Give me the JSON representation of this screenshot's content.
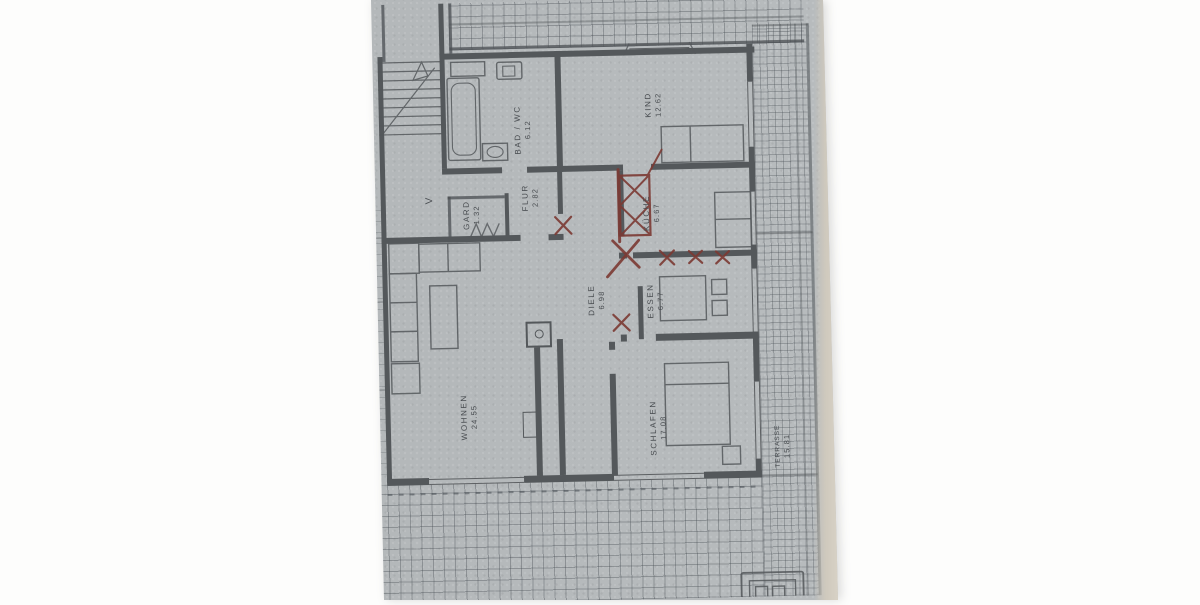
{
  "rooms": {
    "kind": {
      "name": "KIND",
      "area": "12.62"
    },
    "bad": {
      "name": "BAD / WC",
      "area": "6.12"
    },
    "flur": {
      "name": "FLUR",
      "area": "2.82"
    },
    "gard": {
      "name": "GARD",
      "area": "1.32"
    },
    "kueche": {
      "name": "KÜCHE",
      "area": "6.67"
    },
    "diele": {
      "name": "DIELE",
      "area": "6.98"
    },
    "essen": {
      "name": "ESSEN",
      "area": "6.77"
    },
    "wohnen": {
      "name": "WOHNEN",
      "area": "24.55"
    },
    "schlafen": {
      "name": "SCHLAFEN",
      "area": "17.08"
    },
    "terrasse": {
      "name": "TERRASSE",
      "area": "15.81"
    }
  },
  "annotations": {
    "stair_mark": "V"
  },
  "colors": {
    "paper": "#b6babc",
    "ink": "#54585b",
    "red_pencil": "#7c3a33",
    "background": "#fdfdfc",
    "paper_edge": "#d9d3c7"
  }
}
